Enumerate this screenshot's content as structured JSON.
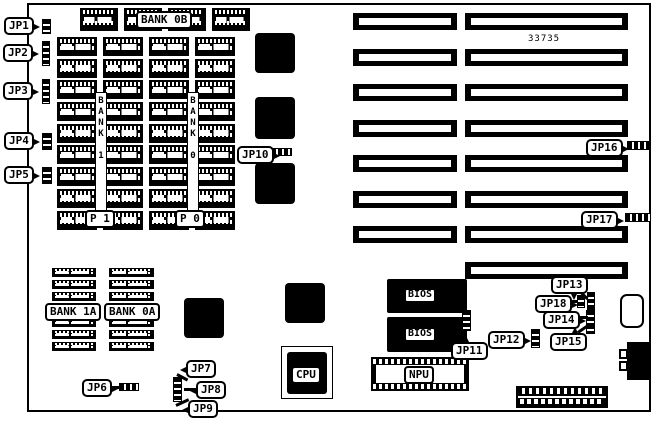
{
  "board": {
    "part_number": "33735"
  },
  "colors": {
    "ink": "#000000",
    "paper": "#ffffff"
  },
  "jumpers": {
    "jp1": "JP1",
    "jp2": "JP2",
    "jp3": "JP3",
    "jp4": "JP4",
    "jp5": "JP5",
    "jp6": "JP6",
    "jp7": "JP7",
    "jp8": "JP8",
    "jp9": "JP9",
    "jp10": "JP10",
    "jp11": "JP11",
    "jp12": "JP12",
    "jp13": "JP13",
    "jp14": "JP14",
    "jp15": "JP15",
    "jp16": "JP16",
    "jp17": "JP17",
    "jp18": "JP18"
  },
  "memory": {
    "bank_0b_label": "BANK 0B",
    "bank_1_vertical": "BANK 1",
    "bank_0_vertical": "BANK 0",
    "p1_label": "P 1",
    "p0_label": "P 0",
    "bank_1a_label": "BANK 1A",
    "bank_0a_label": "BANK 0A",
    "top_row_chip_count": 4,
    "main_array": {
      "columns": 4,
      "rows": 9,
      "chip_count": 36
    },
    "corner_banks": {
      "columns": 2,
      "rows_above": 3,
      "rows_below": 3
    }
  },
  "chips": {
    "cpu_label": "CPU",
    "npu_label": "NPU",
    "bios_label": "BIOS",
    "bios_count": 2,
    "large_square_chip_count": 5
  },
  "slots": {
    "short_count": 7,
    "long_count": 8
  }
}
